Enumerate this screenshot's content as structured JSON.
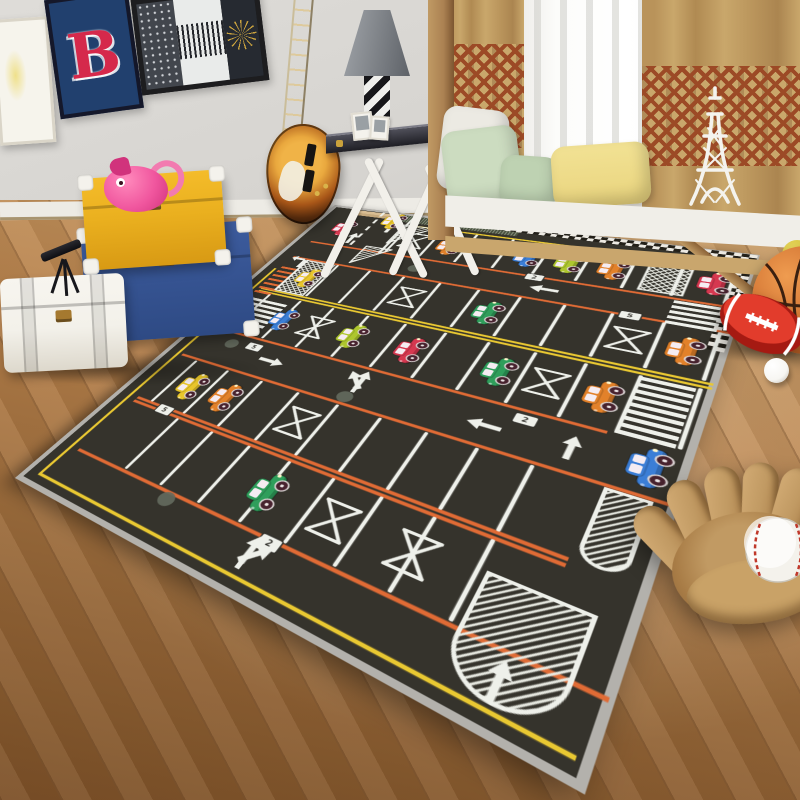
{
  "scene": {
    "description": "Photograph of a children's bedroom with a dark parking-lot play rug on a wooden floor"
  },
  "posters": {
    "letter": "B"
  },
  "colors": {
    "wall": "#d8d6d2",
    "baseboard": "#edebe5",
    "rug_asphalt": "#35332c",
    "rug_binding": "#b3b1ac",
    "line_white": "#eef0ea",
    "line_orange": "#e06b35",
    "line_yellow": "#e9c832",
    "checker_light": "#ece9e2",
    "checker_dark": "#232019",
    "hatch_white": "#e8eae2",
    "dot_gray": "#646a5e",
    "bump_tan": "#d9bd92",
    "band_green": "#49523f",
    "car_blue": "#3b7ed6",
    "car_lime": "#aec62e",
    "car_orange": "#e2812a",
    "car_red": "#d63850",
    "car_green": "#2f9e5b",
    "car_yellow": "#e8c52b",
    "wheel": "#47222e",
    "window_tint": "#f5ecf2",
    "curtain_tan": "#c9a76b",
    "curtain_pattern": "#9c4a26",
    "sheer": "#f3f3f1",
    "window_glow": "#fcfcfa",
    "wood_post": "#ab8152",
    "seat_white": "#f0eee8",
    "seat_wood": "#c9a66d",
    "pillow_green": "#ccdcc0",
    "pillow_green2": "#bed2b2",
    "pillow_yellow": "#e9d47e",
    "pillow_white": "#eceae3",
    "eiffel": "#f4f3ee",
    "poster_navy": "#21406e",
    "poster_red": "#d5294b",
    "frame_dark": "#1d1d1f",
    "art_white": "#f6f4ec",
    "trunk_yellow": "#eab01f",
    "trunk_yellow2": "#d89a14",
    "trunk_blue": "#3d5c9e",
    "trunk_blue2": "#2e4a84",
    "trunk_white": "#f3f1ea",
    "brass": "#a5792f",
    "piggy": "#f0569e",
    "piggy_dark": "#d1337c",
    "guitar_center": "#e9a83e",
    "guitar_mid": "#a85618",
    "guitar_edge": "#1a0e07",
    "lamp_light": "#a0a4a9",
    "lamp_dark": "#5e6268",
    "lamp_base_dark": "#17171a",
    "lamp_base_light": "#efefec",
    "basketball": "#cf7030",
    "basketball_dark": "#8e4517",
    "football": "#c2281c",
    "football_light": "#e23c2c",
    "ball_white": "#f7f6f2",
    "ball_yellow": "#cdb92e",
    "glove": "#c19a63",
    "glove_dark": "#7d5a34",
    "glove_mid": "#a87c46",
    "baseball": "#f4f2ec",
    "stitch": "#c0392b"
  },
  "rug": {
    "width": 680,
    "height": 840,
    "orange_lines": [
      [
        150,
        34,
        676
      ],
      [
        210,
        34,
        676
      ],
      [
        450,
        34,
        598
      ],
      [
        530,
        34,
        676
      ],
      [
        640,
        40,
        612
      ],
      [
        648,
        40,
        612
      ],
      [
        760,
        40,
        676
      ]
    ],
    "yellow_lines": [
      [
        44,
        180,
        672
      ],
      [
        322,
        40,
        676
      ],
      [
        330,
        40,
        676
      ],
      [
        818,
        24,
        668
      ]
    ],
    "yellow_vline": {
      "x": 26,
      "y1": 256,
      "y2": 818
    },
    "road": {
      "solid_x": 172,
      "dash_x": 110,
      "y1": 8,
      "y2": 152
    },
    "band": {
      "x": 150,
      "y": 0,
      "w": 210,
      "h": 26
    },
    "bump": {
      "x": 54,
      "y": 4,
      "w": 100,
      "h": 20
    },
    "checker": {
      "top": {
        "x1": 246,
        "x2": 676,
        "y": 2
      },
      "right": {
        "x": 658,
        "y1": 20,
        "y2": 246
      },
      "cell": 9
    },
    "rows": [
      {
        "y1": 48,
        "y2": 142,
        "xs": [
          180,
          240,
          300,
          360,
          420,
          480,
          540,
          600,
          660
        ]
      },
      {
        "y1": 214,
        "y2": 316,
        "xs": [
          66,
          126,
          186,
          246,
          306,
          366,
          426,
          486,
          546,
          606,
          666
        ]
      },
      {
        "y1": 336,
        "y2": 444,
        "xs": [
          66,
          126,
          186,
          246,
          306,
          366,
          426,
          486,
          546,
          606,
          666
        ]
      },
      {
        "y1": 536,
        "y2": 636,
        "xs": [
          66,
          126,
          186,
          246,
          306,
          366,
          426,
          486,
          546
        ]
      },
      {
        "y1": 652,
        "y2": 754,
        "xs": [
          126,
          186,
          246,
          306,
          366,
          426,
          486,
          546
        ]
      }
    ],
    "xmarks": [
      [
        210,
        95
      ],
      [
        276,
        266
      ],
      [
        576,
        266
      ],
      [
        186,
        390
      ],
      [
        516,
        390
      ],
      [
        276,
        586
      ],
      [
        396,
        704
      ],
      [
        486,
        704
      ]
    ],
    "patches": [
      {
        "type": "x",
        "x": 560,
        "y": 48,
        "w": 52,
        "h": 92
      },
      {
        "type": "x",
        "x": 66,
        "y": 214,
        "w": 54,
        "h": 104
      },
      {
        "type": "tri",
        "pts": "168,44 224,44 168,116"
      },
      {
        "type": "tri",
        "pts": "140,136 188,136 140,198"
      }
    ],
    "islands": [
      {
        "x": 618,
        "y": 535,
        "w": 40,
        "h": 101
      },
      {
        "x": 556,
        "y": 690,
        "w": 92,
        "h": 120
      }
    ],
    "zebras": [
      {
        "x": 606,
        "y": 154,
        "w": 56,
        "h": 54
      },
      {
        "x": 604,
        "y": 336,
        "w": 58,
        "h": 110
      },
      {
        "x": 38,
        "y": 352,
        "w": 74,
        "h": 70
      }
    ],
    "ladder": {
      "x": 34,
      "y": 246,
      "w": 34,
      "n": 7,
      "step": 14
    },
    "dots": [
      [
        250,
        182
      ],
      [
        90,
        476
      ],
      [
        306,
        516
      ],
      [
        208,
        770
      ],
      [
        480,
        60
      ]
    ],
    "plates": [
      {
        "x": 426,
        "y": 152,
        "glyph": "2"
      },
      {
        "x": 128,
        "y": 470,
        "glyph": "5"
      },
      {
        "x": 516,
        "y": 466,
        "glyph": "2"
      },
      {
        "x": 96,
        "y": 644,
        "glyph": "5"
      },
      {
        "x": 352,
        "y": 764,
        "glyph": "2"
      },
      {
        "x": 566,
        "y": 210,
        "glyph": "5"
      }
    ],
    "arrows": [
      {
        "t": "s",
        "x": 100,
        "y": 118,
        "r": 0
      },
      {
        "t": "s",
        "x": 148,
        "y": 62,
        "r": 0
      },
      {
        "t": "hook",
        "x": 56,
        "y": 222,
        "r": 0
      },
      {
        "t": "s",
        "x": 450,
        "y": 180,
        "r": -90
      },
      {
        "t": "s",
        "x": 170,
        "y": 490,
        "r": 90
      },
      {
        "t": "forkL",
        "x": 310,
        "y": 488,
        "r": 0
      },
      {
        "t": "s",
        "x": 480,
        "y": 494,
        "r": -90
      },
      {
        "t": "s",
        "x": 572,
        "y": 492,
        "r": 0
      },
      {
        "t": "forkR",
        "x": 340,
        "y": 792,
        "r": 0
      },
      {
        "t": "s",
        "x": 600,
        "y": 790,
        "r": 0
      }
    ],
    "cars": [
      {
        "color": "red",
        "x": 64,
        "y": 84
      },
      {
        "color": "yellow",
        "x": 140,
        "y": 36
      },
      {
        "color": "orange",
        "x": 270,
        "y": 96
      },
      {
        "color": "blue",
        "x": 396,
        "y": 96
      },
      {
        "color": "lime",
        "x": 456,
        "y": 96
      },
      {
        "color": "orange",
        "x": 516,
        "y": 96
      },
      {
        "color": "red",
        "x": 640,
        "y": 96
      },
      {
        "color": "yellow",
        "x": 96,
        "y": 266
      },
      {
        "color": "green",
        "x": 396,
        "y": 266
      },
      {
        "color": "orange",
        "x": 636,
        "y": 266
      },
      {
        "color": "blue",
        "x": 126,
        "y": 390
      },
      {
        "color": "lime",
        "x": 246,
        "y": 390
      },
      {
        "color": "red",
        "x": 336,
        "y": 390
      },
      {
        "color": "green",
        "x": 456,
        "y": 390
      },
      {
        "color": "orange",
        "x": 576,
        "y": 390
      },
      {
        "color": "blue",
        "x": 644,
        "y": 486
      },
      {
        "color": "yellow",
        "x": 96,
        "y": 586
      },
      {
        "color": "orange",
        "x": 156,
        "y": 586
      },
      {
        "color": "green",
        "x": 306,
        "y": 704
      }
    ]
  }
}
